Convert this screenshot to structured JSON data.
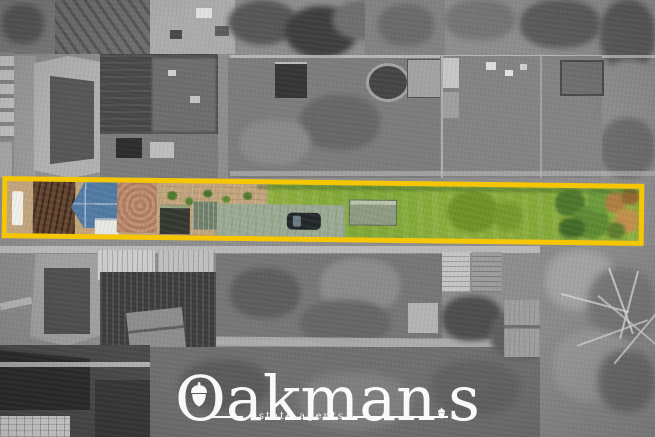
{
  "watermark": {
    "brand_initial": "O",
    "brand_mid": "akman",
    "brand_end": "s",
    "brand_full": "Oakmans",
    "tagline": "estate agents"
  },
  "icons": {
    "logo_o_icon": "acorn-icon",
    "apostrophe_icon": "acorn-icon"
  },
  "palette": {
    "boundary_yellow": "#F6C602",
    "lawn_green": "#84A837",
    "tarp_blue": "#517AA3",
    "paving_tan": "#C2A47C",
    "shrub_green": "#4C772C",
    "autumn_orange": "#B07D42",
    "watermark_white": "#FFFFFF"
  }
}
